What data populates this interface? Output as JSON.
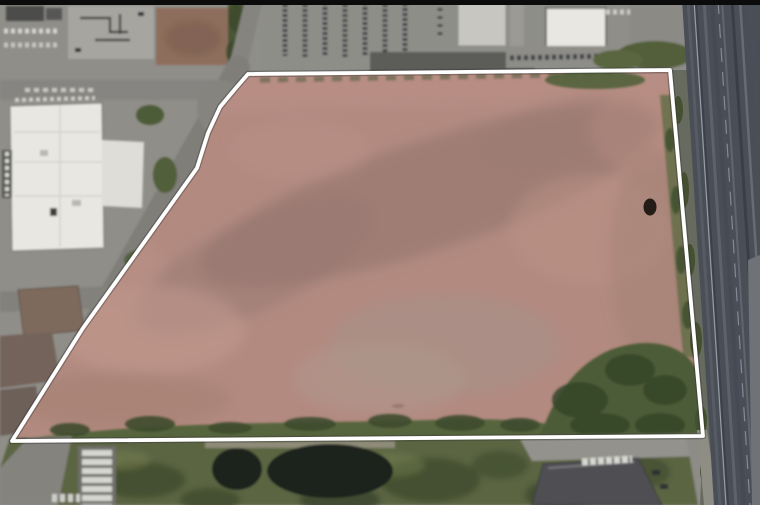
{
  "meta": {
    "kind": "satellite-aerial-photo",
    "subject": "Aerial view of a vacant pink-brown dirt land parcel outlined with a white property boundary, surrounded by industrial buildings, parking lots, ponds and a highway",
    "width": 760,
    "height": 505
  },
  "overlay": {
    "boundary_color": "#ffffff",
    "boundary_shadow_color": "#2e2e2e",
    "boundary_points": "248,74 670,70 703,436 12,441 83,328 197,168 208,133 220,107 235,89"
  },
  "scene": {
    "letterbox_color": "#0b0b0b",
    "base_color": "#8f8e89",
    "field_color": "#b28a80",
    "field_shadow_color": "#8e716a",
    "field_light_color": "#c49b8f",
    "vegetation_color": "#56653e",
    "tree_dark_color": "#36452a",
    "pond_color": "#1d241c",
    "highway_color": "#4a4e57",
    "road_color": "#85847f",
    "white_roof_color": "#e9e7e1",
    "dark_roof_color": "#4f5053",
    "brown_dirt_color": "#8d6e5c",
    "brown_roof_color": "#7e6a5c",
    "shoulder_color": "#676a5e"
  },
  "features": [
    {
      "name": "parcel-field",
      "desc": "large vacant graded dirt parcel, mottled pink-brown"
    },
    {
      "name": "parcel-boundary",
      "desc": "white polygon property line"
    },
    {
      "name": "warehouse-building",
      "desc": "large white-roof industrial building, upper left"
    },
    {
      "name": "highway",
      "desc": "multi-lane highway along right edge"
    },
    {
      "name": "ponds",
      "desc": "two dark retention ponds below south boundary"
    },
    {
      "name": "tree-mass",
      "desc": "trees inside south-east corner of parcel"
    },
    {
      "name": "trailer-rows",
      "desc": "parked white trailers bottom left"
    },
    {
      "name": "dark-building",
      "desc": "dark-roof building bottom right"
    }
  ]
}
